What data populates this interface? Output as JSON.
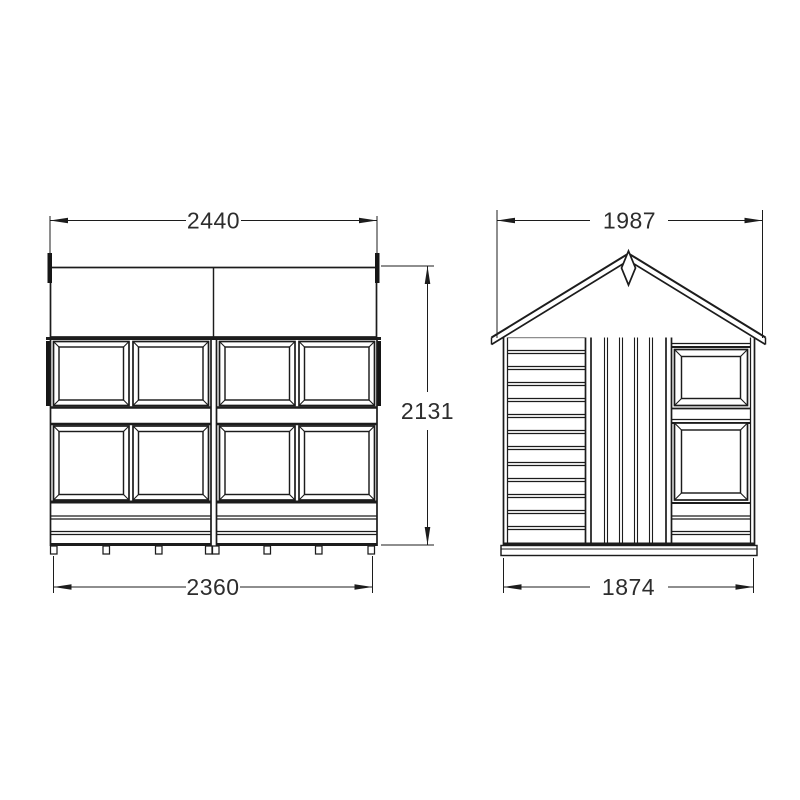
{
  "drawing": {
    "type": "shed technical drawing, front and side elevations",
    "front_view": {
      "top_width": "2440",
      "height": "2131",
      "bottom_width": "2360"
    },
    "side_view": {
      "top_width": "1987",
      "bottom_width": "1874"
    }
  },
  "colors": {
    "background": "#ffffff",
    "line": "#1c1c1c",
    "dimension_text": "#2d2d2d"
  }
}
